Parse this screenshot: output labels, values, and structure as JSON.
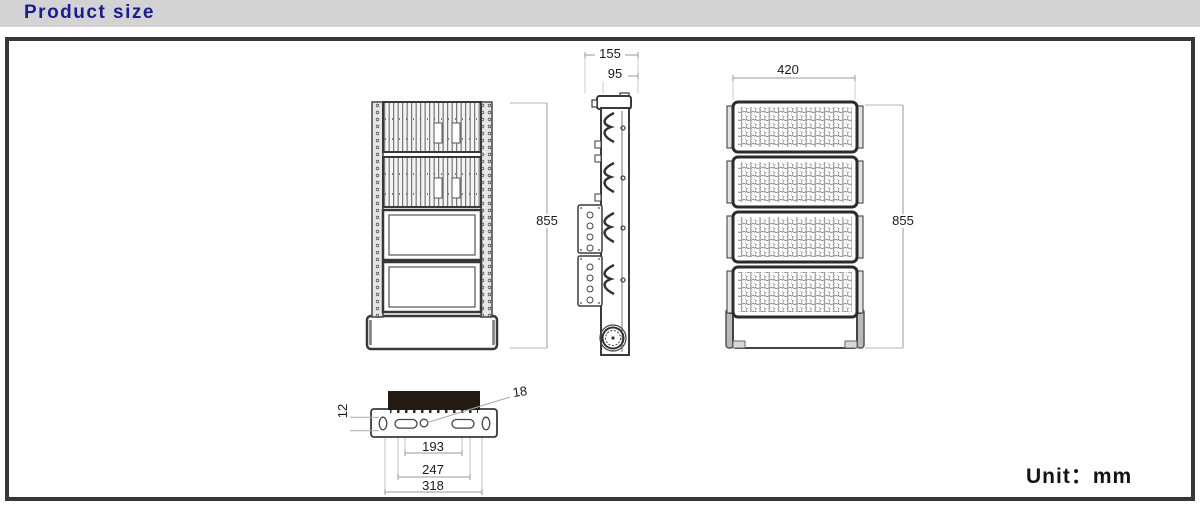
{
  "header": {
    "title": "Product size"
  },
  "unit": {
    "text": "Unit：mm"
  },
  "dimensions": {
    "back_height": "855",
    "side_total_depth": "155",
    "side_body_depth": "95",
    "front_width": "420",
    "front_height": "855",
    "bracket_thickness": "12",
    "mount_hole": "18",
    "slot_spacing_inner": "193",
    "slot_spacing_outer": "247",
    "bracket_width": "318"
  },
  "colors": {
    "header_bg": "#d3d3d3",
    "title_text": "#1c1c90",
    "panel_border": "#3a3634",
    "drawing_line": "#3a3a3a",
    "dim_line": "#999999",
    "label_text": "#1a1a1a",
    "body_fill_dark": "#231a14"
  }
}
